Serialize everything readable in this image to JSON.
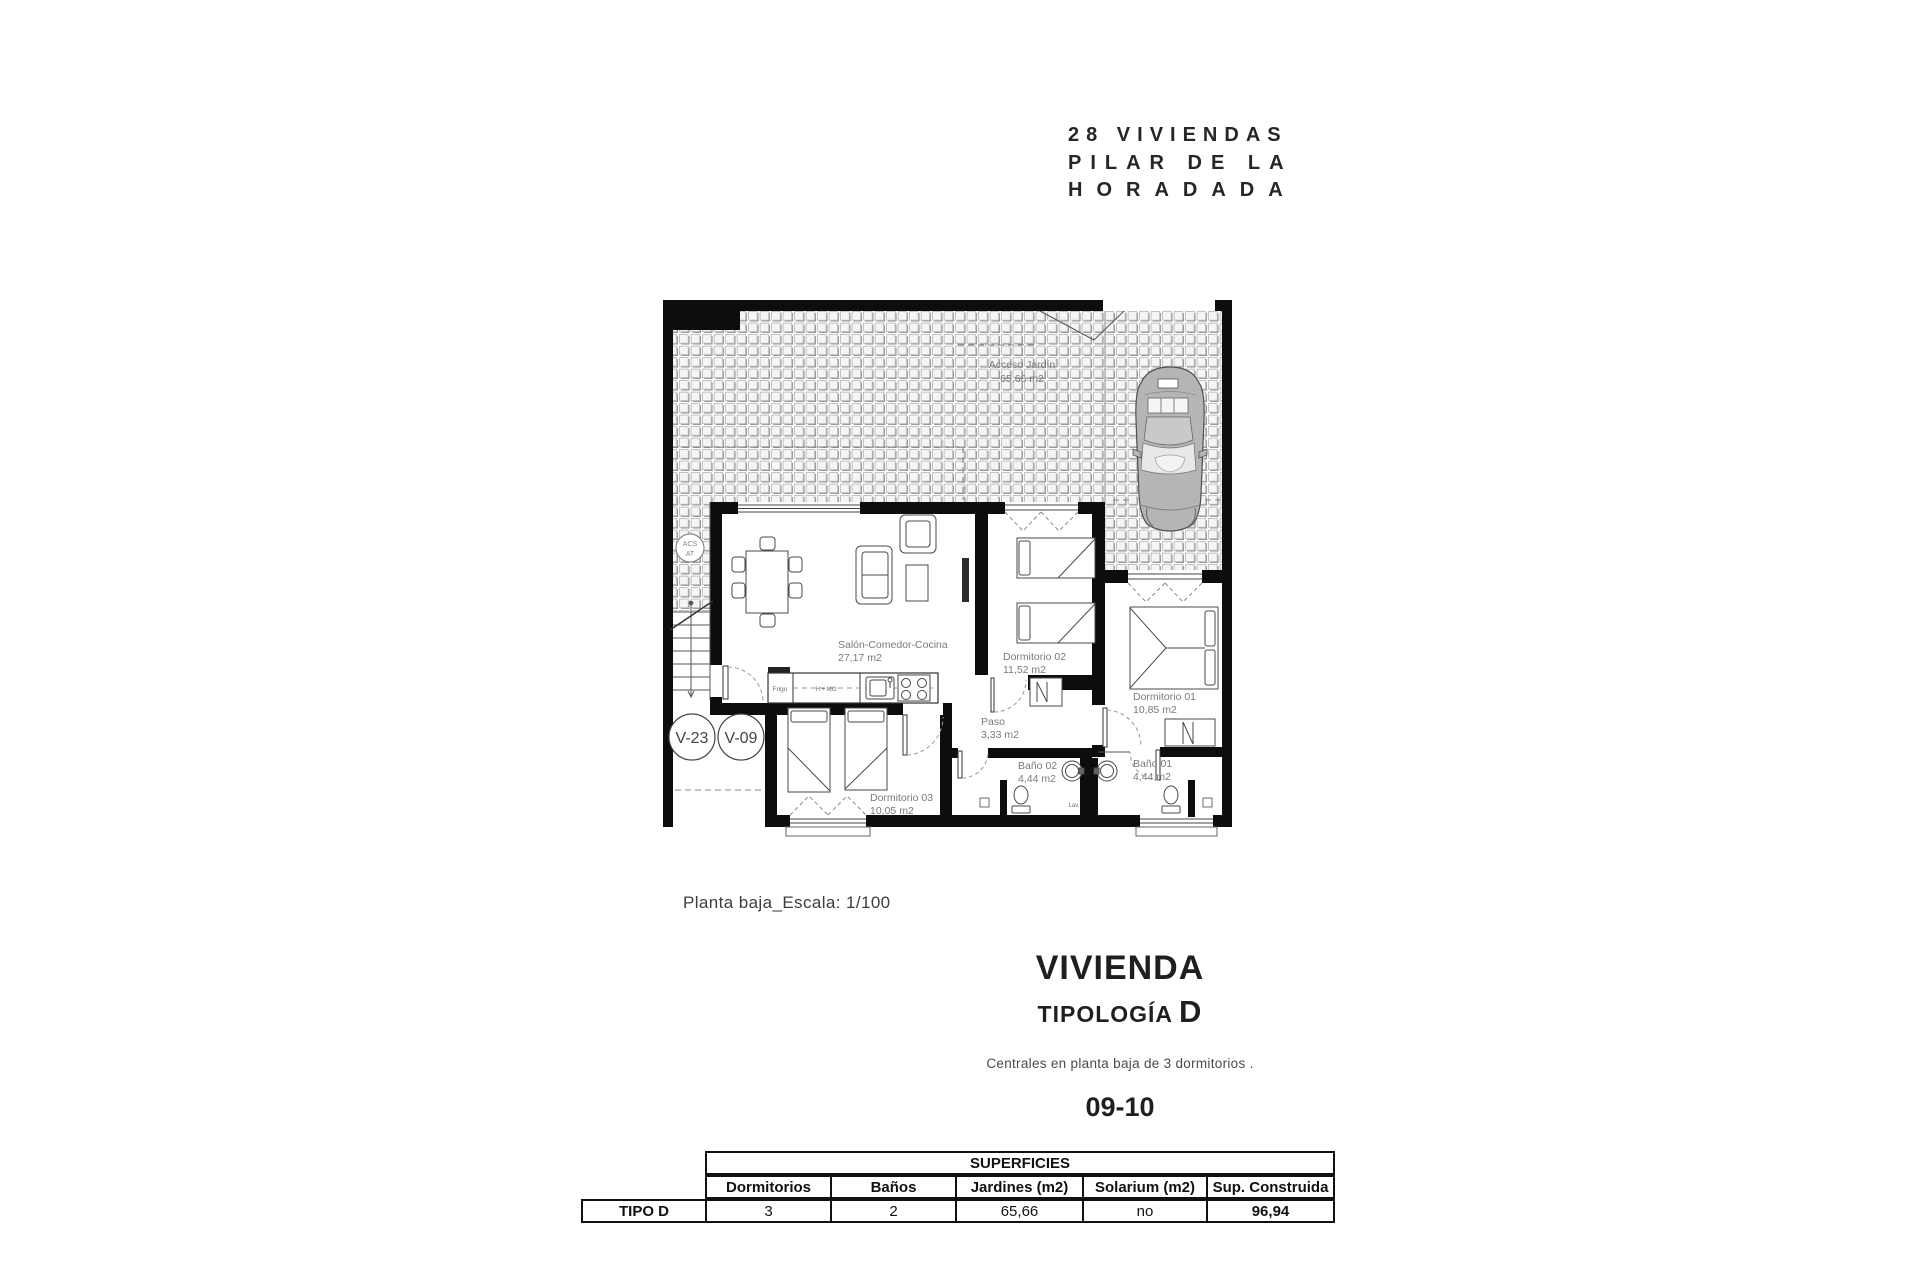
{
  "project": {
    "title_line1": "28 VIVIENDAS",
    "title_line2": "PILAR DE LA",
    "title_line3": "HORADADA"
  },
  "plan": {
    "caption": "Planta baja_Escala: 1/100",
    "garden": {
      "label": "Acceso Jardín",
      "area": "65,66 m2"
    },
    "rooms": [
      {
        "label": "Salón-Comedor-Cocina",
        "area": "27,17 m2"
      },
      {
        "label": "Dormitorio 02",
        "area": "11,52 m2"
      },
      {
        "label": "Dormitorio 01",
        "area": "10,85 m2"
      },
      {
        "label": "Paso",
        "area": "3,33 m2"
      },
      {
        "label": "Baño 02",
        "area": "4,44 m2"
      },
      {
        "label": "Baño 01",
        "area": "4,44 m2"
      },
      {
        "label": "Dormitorio 03",
        "area": "10,05 m2"
      }
    ],
    "annotations": {
      "acs_line1": "ACS",
      "acs_line2": "AT",
      "fridge": "Frigo",
      "oven": "H + MO",
      "sink": "Lav.",
      "v23": "V-23",
      "v09": "V-09"
    }
  },
  "titleblock": {
    "heading": "VIVIENDA",
    "subheading": "TIPOLOGÍA",
    "type_letter": "D",
    "description": "Centrales en planta baja de 3 dormitorios .",
    "units": "09-10"
  },
  "table": {
    "title": "SUPERFICIES",
    "columns": [
      "Dormitorios",
      "Baños",
      "Jardines (m2)",
      "Solarium (m2)",
      "Sup. Construida"
    ],
    "row_label": "TIPO D",
    "values": [
      "3",
      "2",
      "65,66",
      "no",
      "96,94"
    ]
  },
  "colors": {
    "ink": "#1a1a1a",
    "label_gray": "#7a7a7a",
    "tile_gray": "#adadad",
    "car_gray": "#b5b5b5"
  }
}
